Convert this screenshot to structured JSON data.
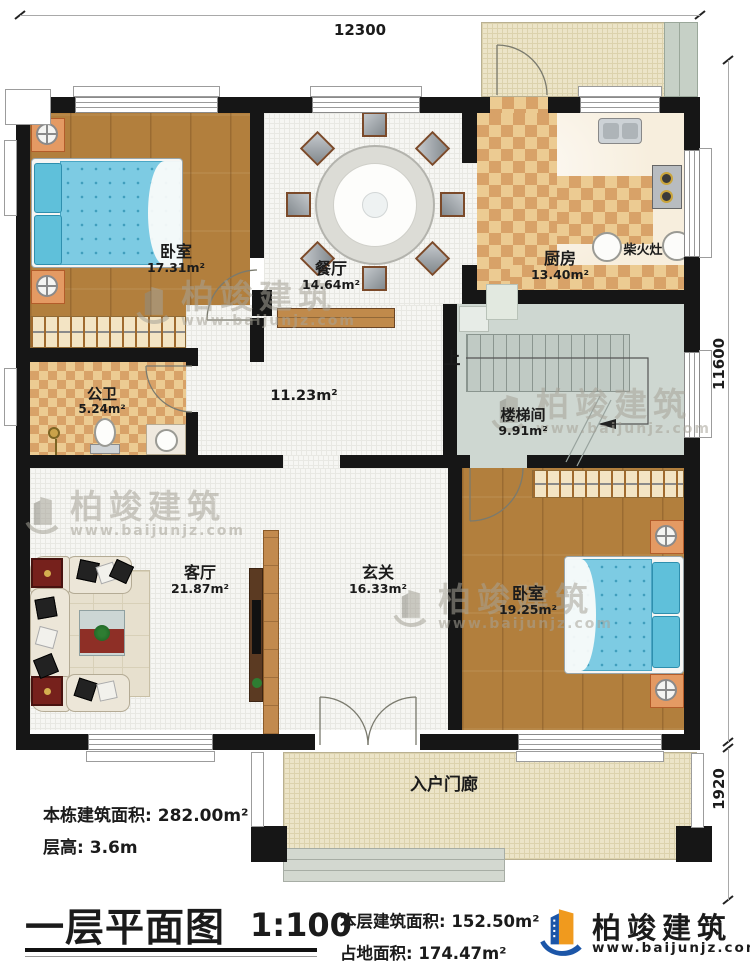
{
  "dims": {
    "top": "12300",
    "right": "11600",
    "bottom_right": "1920"
  },
  "rooms": {
    "bedroom1": {
      "name": "卧室",
      "area": "17.31m²"
    },
    "dining": {
      "name": "餐厅",
      "area": "14.64m²"
    },
    "kitchen": {
      "name": "厨房",
      "area": "13.40m²",
      "stove": "柴火灶"
    },
    "bath": {
      "name": "公卫",
      "area": "5.24m²"
    },
    "hall": {
      "area": "11.23m²"
    },
    "stair": {
      "name": "楼梯间",
      "area": "9.91m²",
      "up": "上"
    },
    "living": {
      "name": "客厅",
      "area": "21.87m²"
    },
    "foyer": {
      "name": "玄关",
      "area": "16.33m²"
    },
    "bedroom2": {
      "name": "卧室",
      "area": "19.25m²"
    },
    "porch": {
      "name": "入户门廊"
    }
  },
  "info": {
    "line1_label": "本栋建筑面积:",
    "line1_value": "282.00m²",
    "line2_label": "层高:",
    "line2_value": "3.6m"
  },
  "titleblock": {
    "title": "一层平面图",
    "scale": "1:100",
    "line1_label": "本层建筑面积:",
    "line1_value": "152.50m²",
    "line2_label": "占地面积:",
    "line2_value": "174.47m²"
  },
  "brand": {
    "name": "柏竣建筑",
    "url": "www.baijunjz.com"
  },
  "watermark": {
    "name": "柏竣建筑",
    "url": "www.baijunjz.com"
  },
  "colors": {
    "brand_blue": "#1c56a8",
    "brand_orange": "#f09a1e",
    "wall": "#161616"
  }
}
